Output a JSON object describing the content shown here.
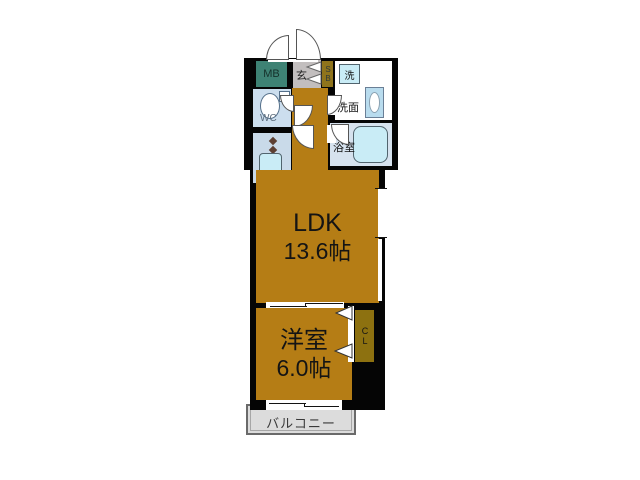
{
  "floorplan": {
    "ldk": {
      "label": "LDK",
      "area": "13.6帖"
    },
    "western_room": {
      "label": "洋室",
      "area": "6.0帖"
    },
    "balcony": {
      "label": "バルコニー"
    },
    "entrance": {
      "label": "玄"
    },
    "shoe_box": {
      "label": "SB"
    },
    "meter_box": {
      "label": "MB"
    },
    "toilet": {
      "label": "WC"
    },
    "washroom": {
      "label": "洗面"
    },
    "washing_machine": {
      "label": "洗"
    },
    "bathroom": {
      "label": "浴室"
    },
    "refrigerator": {
      "label": "冷"
    },
    "closet": {
      "label": "CL"
    },
    "colors": {
      "room_floor": "#b57d15",
      "closet": "#8d7110",
      "meter_box": "#3e8274",
      "shoe_box": "#8f741c",
      "wet_area_floor": "#ccdeee",
      "fixture_blue": "#c9ecf6",
      "wall": "#050505",
      "balcony_gray": "#dcdcdc",
      "entrance_gray": "#c2bebe"
    }
  }
}
